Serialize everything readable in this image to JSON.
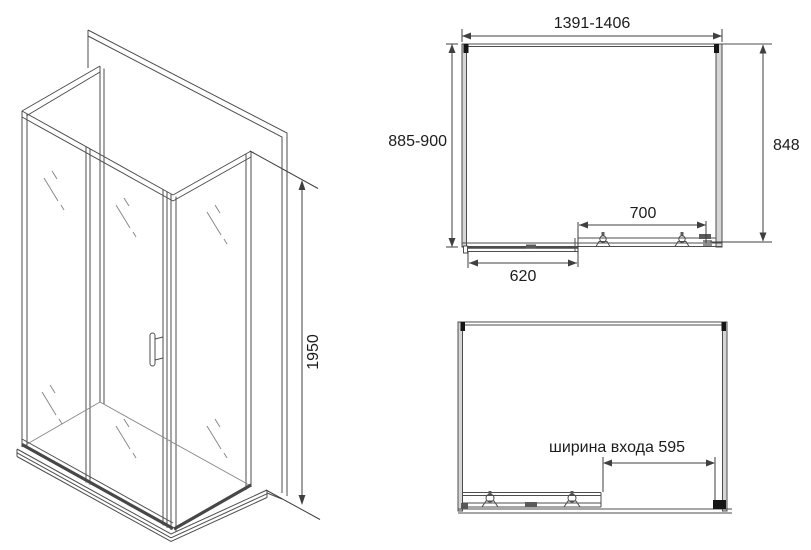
{
  "drawing_type": "shower-enclosure-technical-drawing",
  "colors": {
    "background": "#ffffff",
    "line": "#4d4d4d",
    "light_line": "#8a8a8a",
    "text": "#1c1c1c",
    "profile_fill": "#d6d6d6"
  },
  "isometric_view": {
    "height_dimension": "1950"
  },
  "plan_view": {
    "overall_width": "1391-1406",
    "overall_depth": "885-900",
    "side_width": "848",
    "opening_width": "700",
    "door_panel_width": "620"
  },
  "front_view": {
    "entrance_width": "ширина входа 595"
  }
}
